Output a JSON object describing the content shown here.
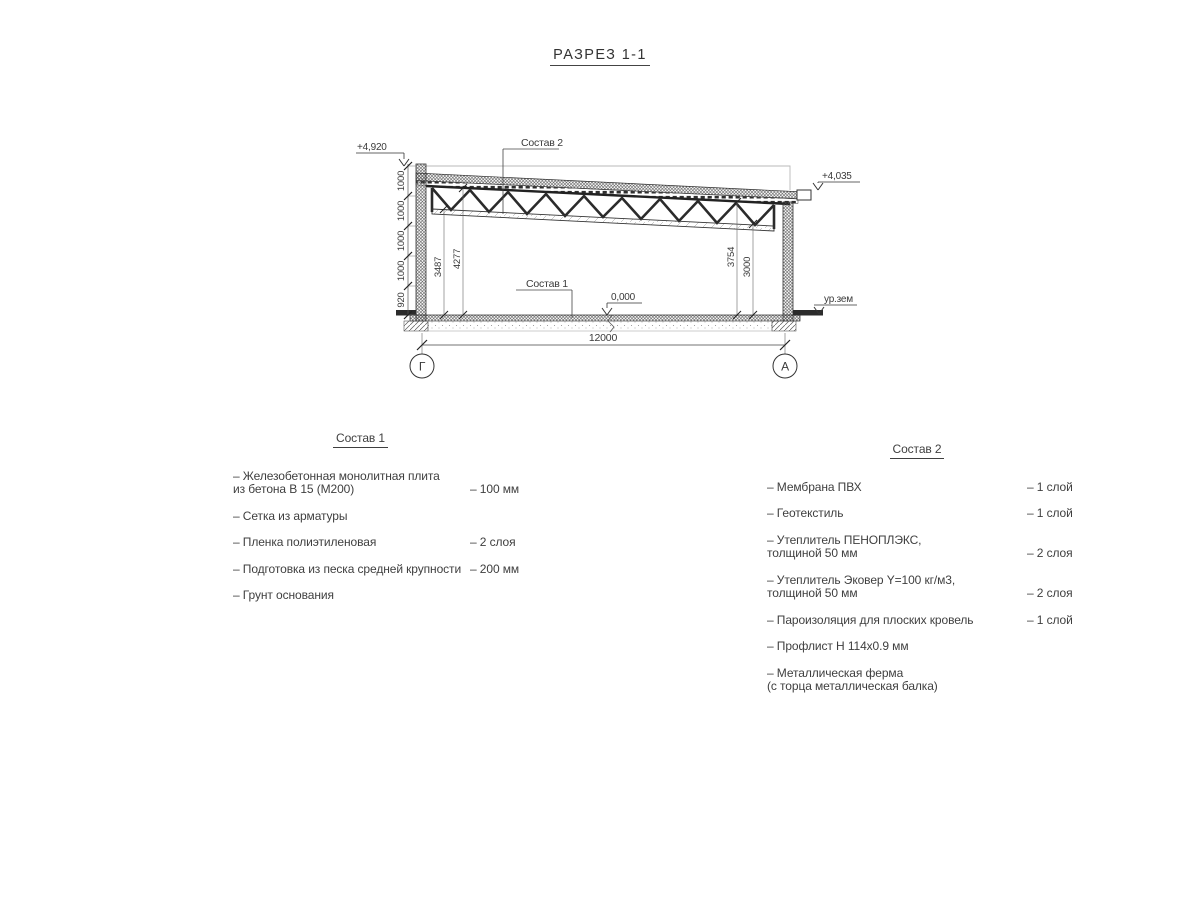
{
  "title": "РАЗРЕЗ 1-1",
  "section": {
    "elev_parapet": "+4,920",
    "elev_roof_right": "+4,035",
    "elev_floor": "0,000",
    "ground_level": "ур.зем",
    "callout_roof": "Состав 2",
    "callout_floor": "Состав 1",
    "left_dims": [
      "1000",
      "1000",
      "1000",
      "1000",
      "920"
    ],
    "inner_dims": {
      "left_bottom": "3487",
      "left_top": "4277",
      "right_top": "3754",
      "right_bottom": "3000"
    },
    "span_dim": "12000",
    "axis_left": "Г",
    "axis_right": "А",
    "line_color": "#333333"
  },
  "sostav1": {
    "title": "Состав 1",
    "items": [
      {
        "name": "– Железобетонная  монолитная плита\nиз бетона В 15 (М200)",
        "value": "– 100 мм"
      },
      {
        "name": "– Сетка из арматуры",
        "value": ""
      },
      {
        "name": "– Пленка полиэтиленовая",
        "value": "– 2 слоя"
      },
      {
        "name": "– Подготовка из песка средней крупности",
        "value": "– 200 мм"
      },
      {
        "name": "– Грунт основания",
        "value": ""
      }
    ]
  },
  "sostav2": {
    "title": "Состав 2",
    "items": [
      {
        "name": "– Мембрана ПВХ",
        "value": "– 1 слой"
      },
      {
        "name": "– Геотекстиль",
        "value": "– 1 слой"
      },
      {
        "name": "– Утеплитель ПЕНОПЛЭКС,\nтолщиной 50 мм",
        "value": "– 2 слоя"
      },
      {
        "name": "– Утеплитель Эковер Y=100 кг/м3,\nтолщиной 50 мм",
        "value": "– 2 слоя"
      },
      {
        "name": "– Пароизоляция для плоских кровель",
        "value": "– 1 слой"
      },
      {
        "name": "– Профлист Н 114х0.9 мм",
        "value": ""
      },
      {
        "name": "– Металлическая ферма\n(с торца металлическая балка)",
        "value": ""
      }
    ]
  }
}
